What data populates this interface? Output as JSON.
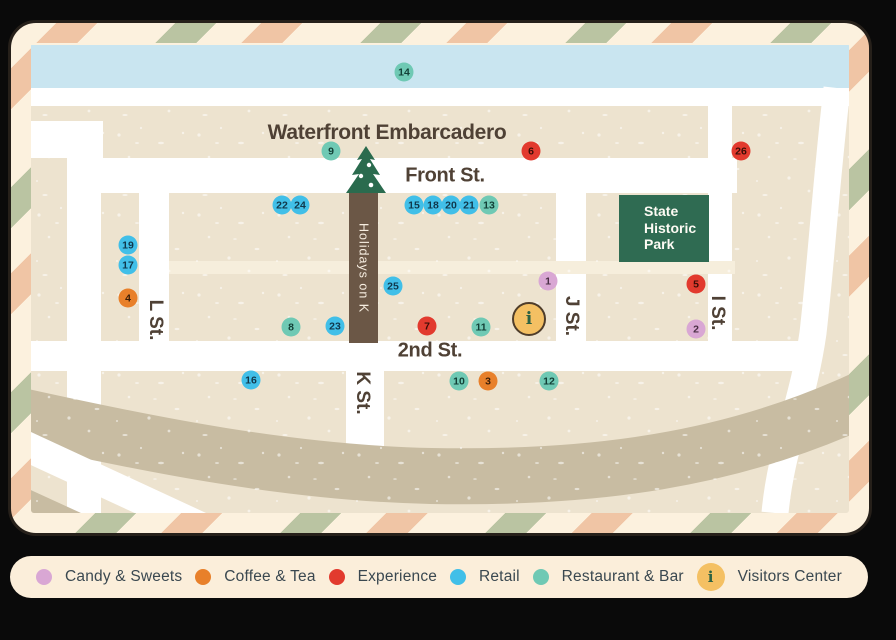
{
  "map": {
    "labels": {
      "waterfront": "Waterfront Embarcadero",
      "front_st": "Front St.",
      "second_st": "2nd St.",
      "l_st": "L St.",
      "k_st": "K St.",
      "j_st": "J St.",
      "i_st": "I St.",
      "holidays_strip": "Holidays on K",
      "state_park": "State Historic Park"
    },
    "markers": [
      {
        "id": "14",
        "type": "restaurant",
        "x": 373,
        "y": 29
      },
      {
        "id": "9",
        "type": "restaurant",
        "x": 300,
        "y": 108
      },
      {
        "id": "6",
        "type": "experience",
        "x": 500,
        "y": 108
      },
      {
        "id": "26",
        "type": "experience",
        "x": 710,
        "y": 108
      },
      {
        "id": "22",
        "type": "retail",
        "x": 251,
        "y": 162
      },
      {
        "id": "24",
        "type": "retail",
        "x": 269,
        "y": 162
      },
      {
        "id": "15",
        "type": "retail",
        "x": 383,
        "y": 162
      },
      {
        "id": "18",
        "type": "retail",
        "x": 402,
        "y": 162
      },
      {
        "id": "20",
        "type": "retail",
        "x": 420,
        "y": 162
      },
      {
        "id": "21",
        "type": "retail",
        "x": 438,
        "y": 162
      },
      {
        "id": "13",
        "type": "restaurant",
        "x": 458,
        "y": 162
      },
      {
        "id": "19",
        "type": "retail",
        "x": 97,
        "y": 202
      },
      {
        "id": "17",
        "type": "retail",
        "x": 97,
        "y": 222
      },
      {
        "id": "4",
        "type": "coffee",
        "x": 97,
        "y": 255
      },
      {
        "id": "25",
        "type": "retail",
        "x": 362,
        "y": 243
      },
      {
        "id": "1",
        "type": "candy",
        "x": 517,
        "y": 238
      },
      {
        "id": "5",
        "type": "experience",
        "x": 665,
        "y": 241
      },
      {
        "id": "8",
        "type": "restaurant",
        "x": 260,
        "y": 284
      },
      {
        "id": "23",
        "type": "retail",
        "x": 304,
        "y": 283
      },
      {
        "id": "7",
        "type": "experience",
        "x": 396,
        "y": 283
      },
      {
        "id": "11",
        "type": "restaurant",
        "x": 450,
        "y": 284
      },
      {
        "id": "i",
        "type": "visitors",
        "x": 498,
        "y": 276
      },
      {
        "id": "2",
        "type": "candy",
        "x": 665,
        "y": 286
      },
      {
        "id": "16",
        "type": "retail",
        "x": 220,
        "y": 337
      },
      {
        "id": "10",
        "type": "restaurant",
        "x": 428,
        "y": 338
      },
      {
        "id": "3",
        "type": "coffee",
        "x": 457,
        "y": 338
      },
      {
        "id": "12",
        "type": "restaurant",
        "x": 518,
        "y": 338
      }
    ]
  },
  "legend": {
    "items": [
      {
        "label": "Candy & Sweets",
        "type": "candy",
        "color": "#D9A7D4"
      },
      {
        "label": "Coffee & Tea",
        "type": "coffee",
        "color": "#E8802A"
      },
      {
        "label": "Experience",
        "type": "experience",
        "color": "#E23A2E"
      },
      {
        "label": "Retail",
        "type": "retail",
        "color": "#41BFE8"
      },
      {
        "label": "Restaurant & Bar",
        "type": "restaurant",
        "color": "#6FC9B4"
      },
      {
        "label": "Visitors Center",
        "type": "visitors",
        "color": "#F4C063",
        "icon": "i"
      }
    ]
  },
  "colors": {
    "water": "#C9E5F0",
    "land": "#EDE3CF",
    "road_white": "#FFFFFF",
    "minor_road": "#F6EEDC",
    "freeway": "#C8BCA2",
    "frame_cream": "#FCF1DE",
    "stripe_peach": "#F0C5A5",
    "stripe_sage": "#BAC4A2",
    "park_green": "#2F6B52",
    "strip_brown": "#6B5746",
    "tree_green": "#2A6B4E",
    "street_text": "#4F4135",
    "legend_bg": "#FBEEDA",
    "legend_text": "#3A4850"
  }
}
